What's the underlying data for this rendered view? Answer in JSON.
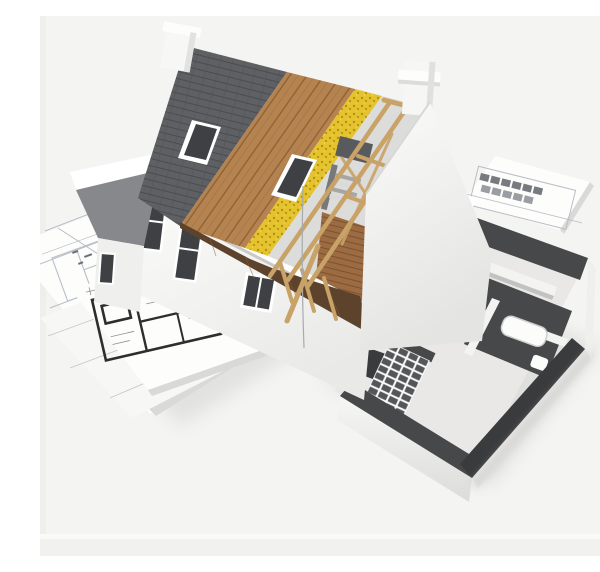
{
  "meta": {
    "title": "3D cutaway house model on architectural blueprints",
    "alt": "3D architectural rendering of a cutaway house under construction: dark shingles, wooden roof sheathing, yellow insulation and exposed rafters on the left wing; a roofless single-storey section with grey-topped walls, kitchen units and a bathtub on the right; the model stands on rolled-out blueprint floor plans."
  },
  "palette": {
    "bg": "#f4f4f2",
    "bg_band": "#ececea",
    "sheet": "#fdfdfc",
    "sheet_edge": "#d9d9d7",
    "bp_line": "#b9bdc6",
    "bp_bold": "#2e2e2e",
    "wall": "#f8f8f7",
    "wall_shade": "#e3e3e1",
    "wall_dark": "#cfcfcd",
    "glass": "#3e4044",
    "trim": "#ffffff",
    "shingle": "#5f6063",
    "shingle_line": "#4b4c4f",
    "wood": "#b5834f",
    "wood_line": "#8a6136",
    "wood_floor": "#9c6b42",
    "insulation": "#e4c32e",
    "insulation_dot": "#b3920f",
    "rafter": "#c9a267",
    "eave_under": "#5e432c",
    "cut_top": "#474849",
    "cut_top_dark": "#3a3b3d",
    "floor_int": "#e9e8e6",
    "wall_int": "#f3f3f1",
    "wall_int_shade": "#c2c2c0",
    "cabinet": "#c8c7c5",
    "cabinet_dark": "#6e6f71",
    "fixture": "#fcfcfb",
    "shadow": "#cfcfcc",
    "gable_dark": "#87888b",
    "block_dark": "#55565a"
  }
}
